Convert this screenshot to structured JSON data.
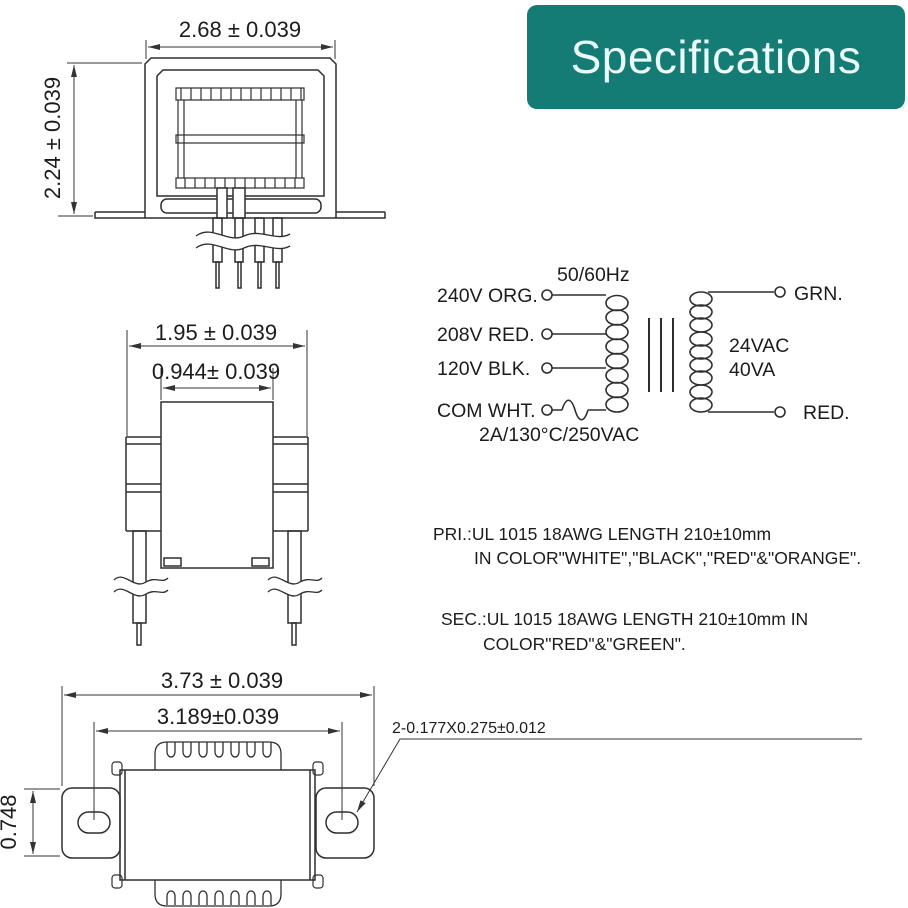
{
  "banner": {
    "title": "Specifications",
    "bg_color": "#147c75",
    "text_color": "#eafaf7"
  },
  "front_view": {
    "width_dim": "2.68 ± 0.039",
    "height_dim": "2.24 ± 0.039"
  },
  "side_view": {
    "outer_dim": "1.95 ± 0.039",
    "inner_dim": "0.944± 0.039"
  },
  "bottom_view": {
    "outer_dim": "3.73 ± 0.039",
    "hole_spacing_dim": "3.189±0.039",
    "flange_height_dim": "0.748",
    "slot_callout": "2-0.177X0.275±0.012"
  },
  "schematic": {
    "frequency": "50/60Hz",
    "primary_taps": [
      "240V ORG.",
      "208V RED.",
      "120V BLK.",
      "COM WHT."
    ],
    "fuse_rating": "2A/130°C/250VAC",
    "secondary_top": "GRN.",
    "secondary_bottom": "RED.",
    "output_voltage": "24VAC",
    "output_power": "40VA"
  },
  "notes": {
    "pri_line1": "PRI.:UL 1015 18AWG LENGTH 210±10mm",
    "pri_line2": "IN COLOR\"WHITE\",\"BLACK\",\"RED\"&\"ORANGE\".",
    "sec_line1": "SEC.:UL 1015 18AWG LENGTH 210±10mm IN",
    "sec_line2": "COLOR\"RED\"&\"GREEN\"."
  },
  "line_color": "#2f2f2f"
}
